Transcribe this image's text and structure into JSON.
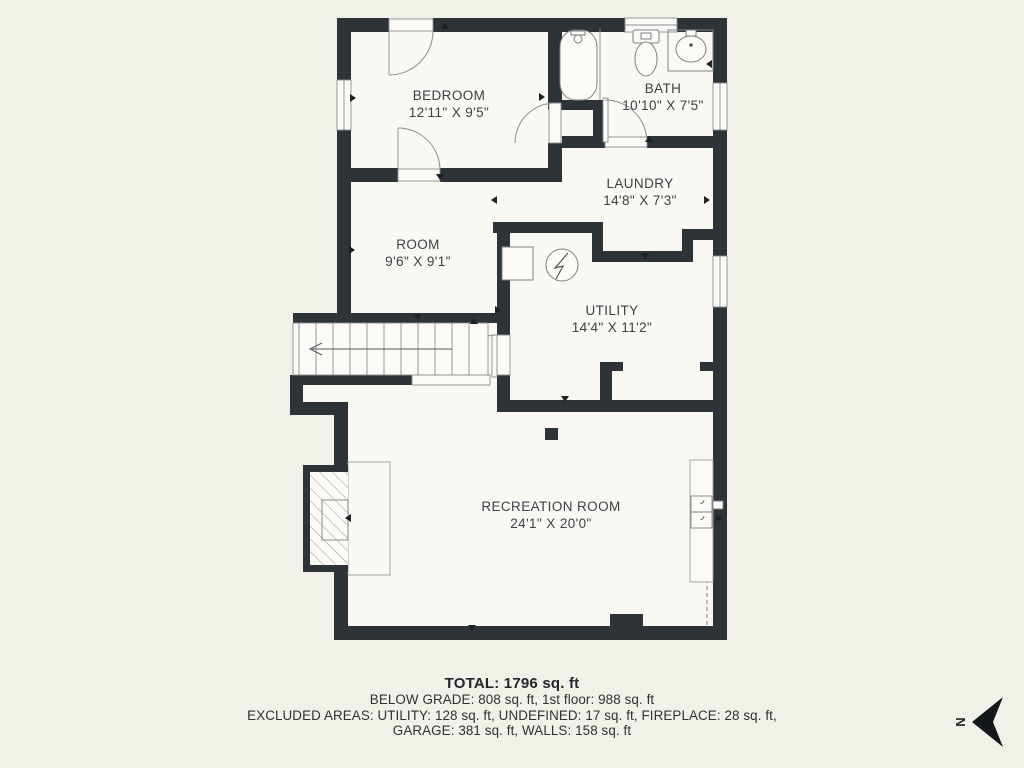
{
  "rooms": {
    "bedroom": {
      "name": "BEDROOM",
      "dims": "12'11\" X 9'5\""
    },
    "bath": {
      "name": "BATH",
      "dims": "10'10\" X 7'5\""
    },
    "laundry": {
      "name": "LAUNDRY",
      "dims": "14'8\" X 7'3\""
    },
    "room": {
      "name": "ROOM",
      "dims": "9'6\" X 9'1\""
    },
    "utility": {
      "name": "UTILITY",
      "dims": "14'4\" X 11'2\""
    },
    "recreation": {
      "name": "RECREATION ROOM",
      "dims": "24'1\" X 20'0\""
    }
  },
  "summary": {
    "total": "TOTAL: 1796 sq. ft",
    "grade_line": "BELOW GRADE: 808 sq. ft, 1st floor: 988 sq. ft",
    "excluded_line1": "EXCLUDED AREAS: UTILITY: 128 sq. ft, UNDEFINED: 17 sq. ft, FIREPLACE: 28 sq. ft,",
    "excluded_line2": "GARAGE: 381 sq. ft, WALLS: 158 sq. ft"
  },
  "compass": {
    "label": "N"
  },
  "colors": {
    "wall": "#2e3338",
    "background": "#f1f0e9",
    "floor": "#f9f8f3",
    "text": "#3c4148"
  }
}
